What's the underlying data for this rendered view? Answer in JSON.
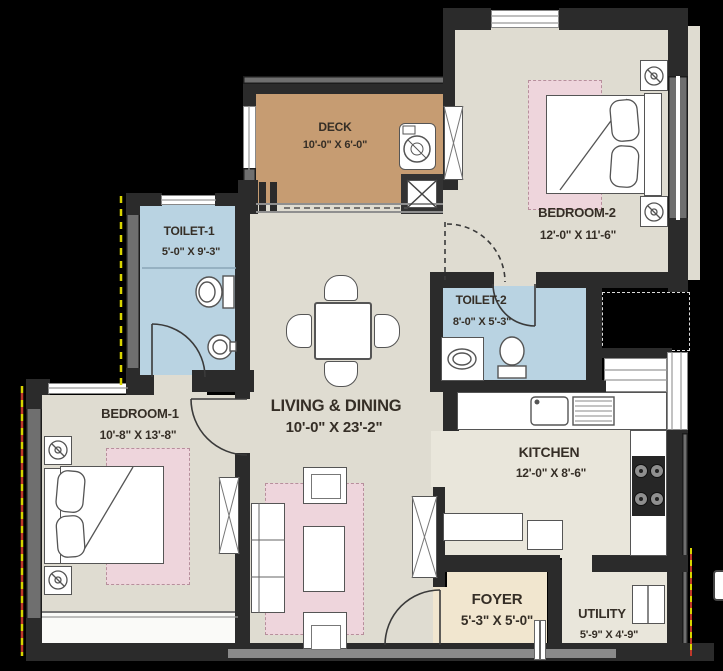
{
  "plan_title": "2BHK apartment floor plan",
  "rooms": {
    "deck": {
      "name": "DECK",
      "dims": "10'-0\" X 6'-0\""
    },
    "bedroom2": {
      "name": "BEDROOM-2",
      "dims": "12'-0\" X 11'-6\""
    },
    "toilet1": {
      "name": "TOILET-1",
      "dims": "5'-0\" X 9'-3\""
    },
    "toilet2": {
      "name": "TOILET-2",
      "dims": "8'-0\" X 5'-3\""
    },
    "living": {
      "name": "LIVING & DINING",
      "dims": "10'-0\" X 23'-2\""
    },
    "bedroom1": {
      "name": "BEDROOM-1",
      "dims": "10'-8\" X 13'-8\""
    },
    "kitchen": {
      "name": "KITCHEN",
      "dims": "12'-0\" X 8'-6\""
    },
    "foyer": {
      "name": "FOYER",
      "dims": "5'-3\" X 5'-0\""
    },
    "utility": {
      "name": "UTILITY",
      "dims": "5'-9\" X 4'-9\""
    }
  },
  "colors": {
    "background": "#000000",
    "wall": "#2b2b2b",
    "wall_light": "#6f6f6f",
    "floor": "#dfdcd1",
    "kitchen_floor": "#e9e6db",
    "deck_floor": "#c69c72",
    "bath_floor": "#b9d3e2",
    "foyer_floor": "#f1e6cf",
    "rug": "#eed5dc",
    "label_text": "#352e26",
    "boundary_dash_yellow": "#d8d400",
    "boundary_dash_red": "#c0392b"
  },
  "icons": [
    "washing-machine-icon",
    "floor-trap-icon",
    "double-bed",
    "pillow",
    "nightstand-lamp",
    "wardrobe-icon",
    "toilet-wc-icon",
    "wash-basin-icon",
    "dining-table",
    "dining-chair",
    "sofa",
    "armchair",
    "coffee-table",
    "tv-unit",
    "kitchen-sink-icon",
    "drainboard",
    "stove-icon",
    "door-swing-arc",
    "window",
    "counter"
  ]
}
